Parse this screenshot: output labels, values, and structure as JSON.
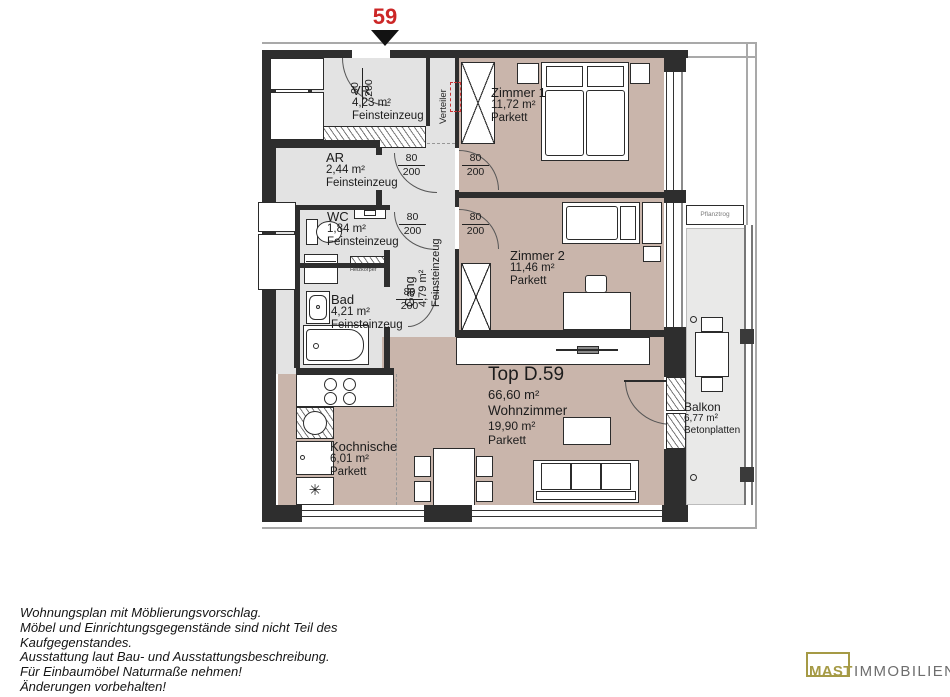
{
  "unit": {
    "number": "59",
    "top_label": "Top D.59",
    "total_area": "66,60 m²"
  },
  "rooms": {
    "vr": {
      "name": "VR",
      "area": "4,23 m²",
      "floor": "Feinsteinzeug"
    },
    "ar": {
      "name": "AR",
      "area": "2,44 m²",
      "floor": "Feinsteinzeug"
    },
    "wc": {
      "name": "WC",
      "area": "1,84 m²",
      "floor": "Feinsteinzeug"
    },
    "bad": {
      "name": "Bad",
      "area": "4,21 m²",
      "floor": "Feinsteinzeug"
    },
    "gang": {
      "name": "Gang",
      "area": "4,79 m²",
      "floor": "Feinsteinzeug"
    },
    "zimmer1": {
      "name": "Zimmer 1",
      "area": "11,72 m²",
      "floor": "Parkett"
    },
    "zimmer2": {
      "name": "Zimmer 2",
      "area": "11,46 m²",
      "floor": "Parkett"
    },
    "wohnzimmer": {
      "name": "Wohnzimmer",
      "area": "19,90 m²",
      "floor": "Parkett"
    },
    "kochnische": {
      "name": "Kochnische",
      "area": "6,01 m²",
      "floor": "Parkett"
    },
    "balkon": {
      "name": "Balkon",
      "area": "6,77 m²",
      "floor": "Betonplatten"
    }
  },
  "annotations": {
    "verteiler": "Verteiler",
    "pflanztrog": "Pflanztrog",
    "heizkoerper": "Heizkörper",
    "freezer_symbol": "✳"
  },
  "doors": {
    "entrance": {
      "width": "90",
      "height": "200"
    },
    "interior": {
      "width": "80",
      "height": "200"
    }
  },
  "footer": {
    "lines": [
      "Wohnungsplan mit Möblierungsvorschlag.",
      "Möbel und Einrichtungsgegenstände sind nicht Teil des",
      "Kaufgegenstandes.",
      "Ausstattung laut Bau- und Ausstattungsbeschreibung.",
      "Für Einbaumöbel Naturmaße nehmen!",
      "Änderungen vorbehalten!"
    ]
  },
  "logo": {
    "primary": "MAST",
    "secondary": "IMMOBILIEN"
  },
  "colors": {
    "unit_marker": "#cc2727",
    "parkett": "#c9b5ab",
    "tile": "#e3e3e3",
    "balcony": "#e9e9e8",
    "logo_gold": "#a59a45",
    "logo_gray": "#6e6e6e"
  }
}
